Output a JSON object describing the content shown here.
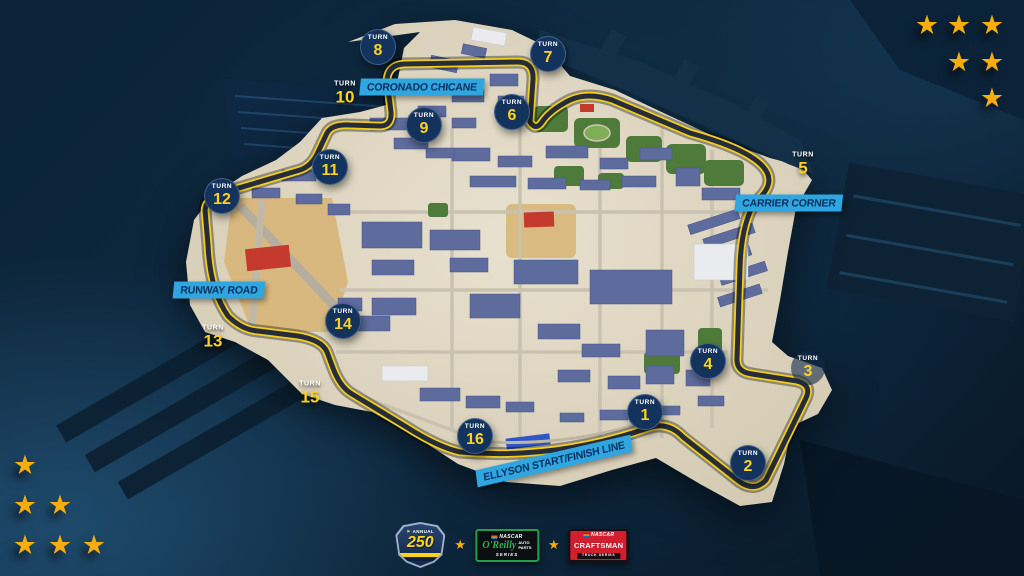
{
  "map": {
    "corner_labels": [
      {
        "id": "coronado-chicane",
        "text": "CORONADO CHICANE",
        "x": 422,
        "y": 87,
        "rotate": 0
      },
      {
        "id": "carrier-corner",
        "text": "CARRIER CORNER",
        "x": 789,
        "y": 203,
        "rotate": 0
      },
      {
        "id": "runway-road",
        "text": "RUNWAY ROAD",
        "x": 219,
        "y": 290,
        "rotate": 0
      },
      {
        "id": "ellyson-start-finish-line",
        "text": "ELLYSON START/FINISH LINE",
        "x": 554,
        "y": 461,
        "rotate": -13
      }
    ],
    "turns": [
      {
        "number": "1",
        "word": "TURN",
        "style": "circle",
        "x": 645,
        "y": 412
      },
      {
        "number": "2",
        "word": "TURN",
        "style": "circle",
        "x": 748,
        "y": 463
      },
      {
        "number": "3",
        "word": "TURN",
        "style": "faint",
        "x": 808,
        "y": 368
      },
      {
        "number": "4",
        "word": "TURN",
        "style": "circle",
        "x": 708,
        "y": 361
      },
      {
        "number": "5",
        "word": "TURN",
        "style": "plain",
        "x": 803,
        "y": 164
      },
      {
        "number": "6",
        "word": "TURN",
        "style": "circle",
        "x": 512,
        "y": 112
      },
      {
        "number": "7",
        "word": "TURN",
        "style": "circle",
        "x": 548,
        "y": 54
      },
      {
        "number": "8",
        "word": "TURN",
        "style": "circle",
        "x": 378,
        "y": 47
      },
      {
        "number": "9",
        "word": "TURN",
        "style": "circle",
        "x": 424,
        "y": 125
      },
      {
        "number": "10",
        "word": "TURN",
        "style": "plain",
        "x": 345,
        "y": 93
      },
      {
        "number": "11",
        "word": "TURN",
        "style": "circle",
        "x": 330,
        "y": 167
      },
      {
        "number": "12",
        "word": "TURN",
        "style": "circle",
        "x": 222,
        "y": 196
      },
      {
        "number": "13",
        "word": "TURN",
        "style": "plain",
        "x": 213,
        "y": 337
      },
      {
        "number": "14",
        "word": "TURN",
        "style": "circle",
        "x": 343,
        "y": 321
      },
      {
        "number": "15",
        "word": "TURN",
        "style": "plain",
        "x": 310,
        "y": 393
      },
      {
        "number": "16",
        "word": "TURN",
        "style": "circle",
        "x": 475,
        "y": 436
      }
    ],
    "colors": {
      "accent_cyan": "#2fa6e0",
      "turn_marker_navy": "#14335c",
      "turn_number_yellow": "#ffd21e",
      "track_edge_yellow": "#f2cf1d",
      "star_gold": "#f7ad0e"
    }
  },
  "decor": {
    "star_glyph": "★",
    "top_right_stars": [
      [
        927,
        27
      ],
      [
        959,
        27
      ],
      [
        992,
        27
      ],
      [
        959,
        64
      ],
      [
        992,
        64
      ],
      [
        992,
        100
      ]
    ],
    "bottom_left_stars": [
      [
        25,
        467
      ],
      [
        25,
        507
      ],
      [
        60,
        507
      ],
      [
        25,
        547
      ],
      [
        60,
        547
      ],
      [
        94,
        547
      ]
    ]
  },
  "footer": {
    "badge": {
      "top": "ANNUAL",
      "number": "250"
    },
    "series1": {
      "brand": "NASCAR",
      "script": "O'Reilly",
      "stack1": "AUTO",
      "stack2": "PARTS",
      "bottom": "SERIES"
    },
    "series2": {
      "brand": "NASCAR",
      "name": "CRAFTSMAN",
      "bottom": "TRUCK SERIES"
    }
  }
}
